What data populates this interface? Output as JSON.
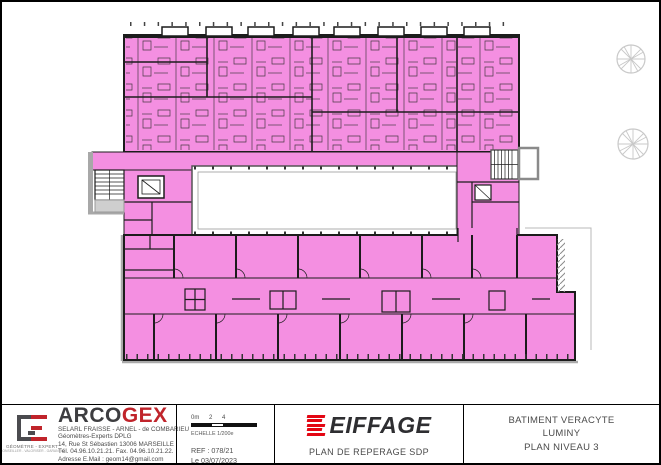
{
  "plan": {
    "highlight_color": "#f48fe1",
    "wall_color": "#1c1c1c",
    "facade_gray": "#a8a8a8",
    "tree_color": "#c9c9c9"
  },
  "title_block": {
    "surveyor": {
      "brand_prefix": "ARCO",
      "brand_suffix": "GEX",
      "logo_caption": "GÉOMÈTRE - EXPERT",
      "logo_subcaption": "CONSEILLER - VALORISER - GARANTIR",
      "line1": "SELARL FRAISSE - ARNEL - de COMBARIEU",
      "line2": "Géomètres-Experts DPLG",
      "line3": "14, Rue St Sébastien  13006 MARSEILLE",
      "line4": "Tél. 04.96.10.21.21.  Fax. 04.96.10.21.22.",
      "line5": "Adresse E.Mail : geom14@gmail.com"
    },
    "scale_box": {
      "tick0": "0m",
      "tick2": "2",
      "tick4": "4",
      "scale_label": "ECHELLE 1/200e",
      "reference": "REF : 078/21",
      "date": "Le 03/07/2023"
    },
    "company_box": {
      "brand": "EIFFAGE",
      "plan_title": "PLAN DE REPERAGE SDP"
    },
    "project_box": {
      "line1": "BATIMENT VERACYTE",
      "line2": "LUMINY",
      "line3": "PLAN NIVEAU 3"
    }
  }
}
